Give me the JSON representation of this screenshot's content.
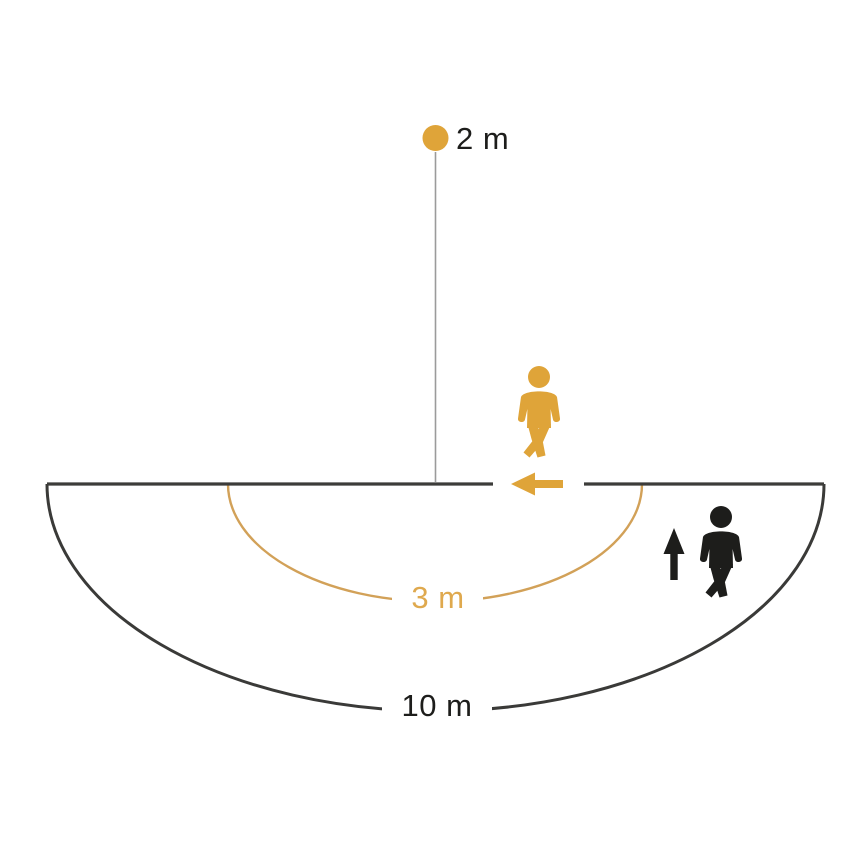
{
  "labels": {
    "mounting_height": "2 m",
    "radial_range": "3 m",
    "tangential_range": "10 m"
  },
  "colors": {
    "orange": "#DFA439",
    "orange_arc": "#D2A158",
    "orange_text": "#DFA94E",
    "black": "#1D1D1B",
    "line_dark": "#3C3C3A",
    "line_gray": "#9B9B9B",
    "background": "#FFFFFF"
  },
  "icons": {
    "sensor_dot": "filled-circle",
    "approaching_person": "walking-person",
    "crossing_person": "walking-person",
    "approach_arrow": "arrow-left",
    "cross_arrow": "arrow-up"
  }
}
